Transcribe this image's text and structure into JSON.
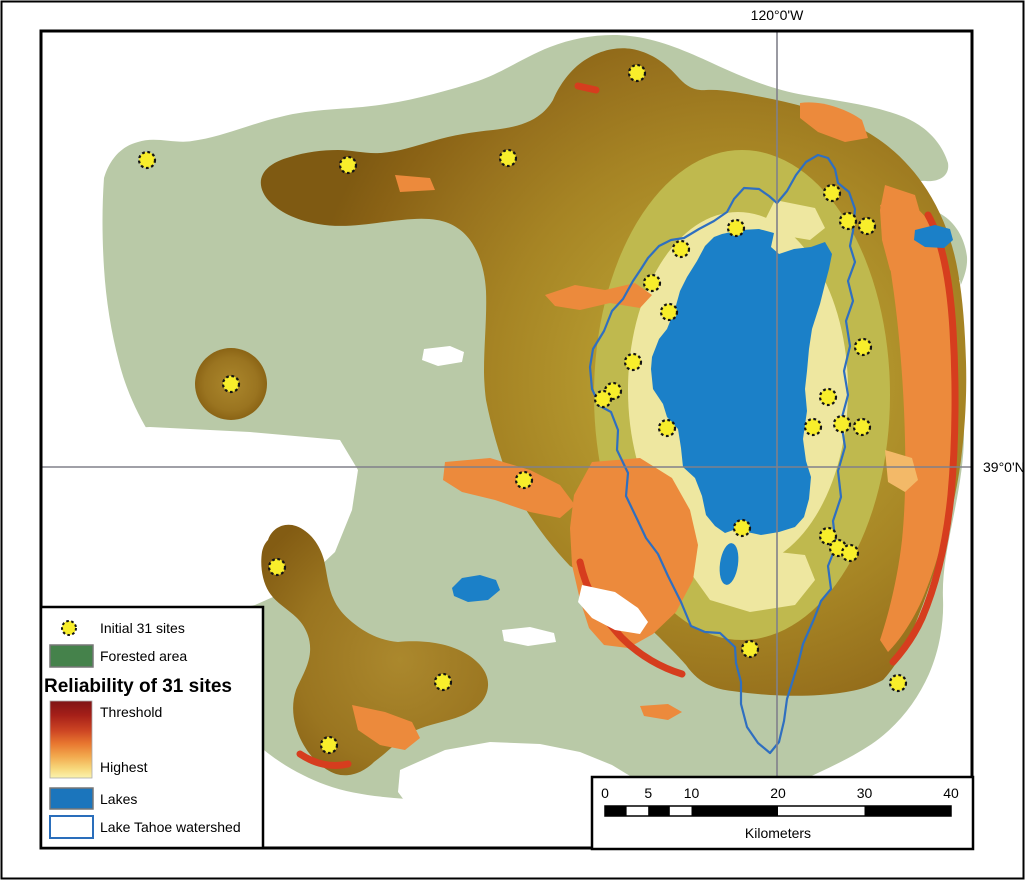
{
  "map": {
    "grid": {
      "lon_label": "120°0'W",
      "lat_label": "39°0'N"
    },
    "sites_count": 31,
    "sites": [
      [
        147,
        160
      ],
      [
        348,
        165
      ],
      [
        508,
        158
      ],
      [
        637,
        73
      ],
      [
        736,
        228
      ],
      [
        681,
        249
      ],
      [
        652,
        283
      ],
      [
        669,
        312
      ],
      [
        633,
        362
      ],
      [
        613,
        391
      ],
      [
        603,
        399
      ],
      [
        667,
        428
      ],
      [
        524,
        480
      ],
      [
        832,
        193
      ],
      [
        848,
        221
      ],
      [
        867,
        226
      ],
      [
        863,
        347
      ],
      [
        828,
        397
      ],
      [
        813,
        427
      ],
      [
        842,
        424
      ],
      [
        862,
        427
      ],
      [
        742,
        528
      ],
      [
        828,
        536
      ],
      [
        838,
        548
      ],
      [
        850,
        553
      ],
      [
        750,
        649
      ],
      [
        898,
        683
      ],
      [
        231,
        384
      ],
      [
        277,
        567
      ],
      [
        443,
        682
      ],
      [
        329,
        745
      ]
    ],
    "features": {
      "lake": "Lake Tahoe",
      "watershed": "Lake Tahoe watershed"
    },
    "colors": {
      "forested_green": "#b9c9a7",
      "reliability_threshold_red": "#7f1416",
      "reliability_highest_yellow": "#fbf3ae",
      "surface_brown_dark": "#7f5a12",
      "surface_brown_light": "#c4ab38",
      "surface_orange": "#ec8a3c",
      "surface_red_edge": "#d63d1e",
      "lake_blue": "#1b80c8",
      "watershed_outline_blue": "#2f6fc0",
      "site_yellow": "#f8ee2b",
      "grid_gray": "#808088"
    }
  },
  "legend": {
    "initial_sites_label": "Initial 31 sites",
    "forested_label": "Forested area",
    "title": "Reliability of 31 sites",
    "threshold_label": "Threshold",
    "highest_label": "Highest",
    "lakes_label": "Lakes",
    "watershed_label": "Lake Tahoe watershed"
  },
  "scalebar": {
    "ticks": [
      {
        "label": "0",
        "km": 0
      },
      {
        "label": "5",
        "km": 5
      },
      {
        "label": "10",
        "km": 10
      },
      {
        "label": "20",
        "km": 20
      },
      {
        "label": "30",
        "km": 30
      },
      {
        "label": "40",
        "km": 40
      }
    ],
    "unit_label": "Kilometers"
  }
}
